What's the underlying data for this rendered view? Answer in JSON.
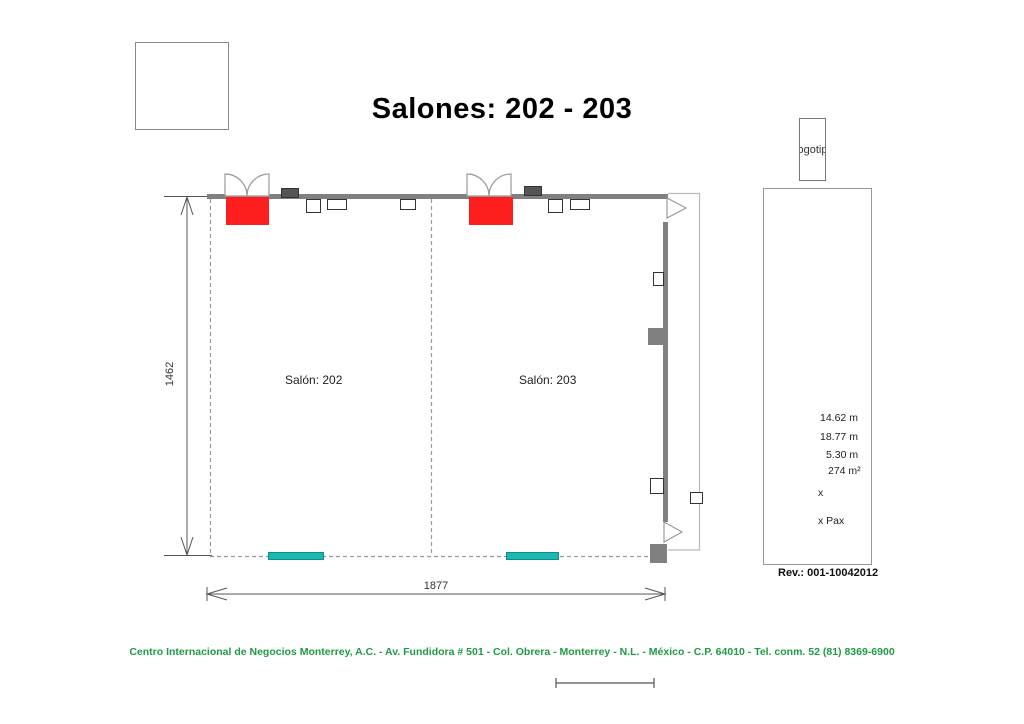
{
  "title": "Salones: 202 - 203",
  "logo_box": {
    "label": "Logotipo"
  },
  "rooms": [
    {
      "label": "Salón: 202"
    },
    {
      "label": "Salón: 203"
    }
  ],
  "dimensions": {
    "height_label": "1462",
    "width_label": "1877"
  },
  "info_panel": {
    "specs": [
      "14.62 m",
      "18.77 m",
      "5.30 m",
      "274 m²",
      "x",
      "x Pax"
    ],
    "revision": "Rev.: 001-10042012"
  },
  "footer": {
    "text": "Centro Internacional de Negocios Monterrey, A.C. - Av. Fundidora # 501 - Col. Obrera - Monterrey - N.L. - México - C.P. 64010 - Tel. conm. 52 (81) 8369-6900"
  },
  "colors": {
    "wall_gray": "#808080",
    "door_red": "#fe1e1e",
    "strip_teal": "#1ab7b3",
    "footer_green": "#1f9a45"
  }
}
